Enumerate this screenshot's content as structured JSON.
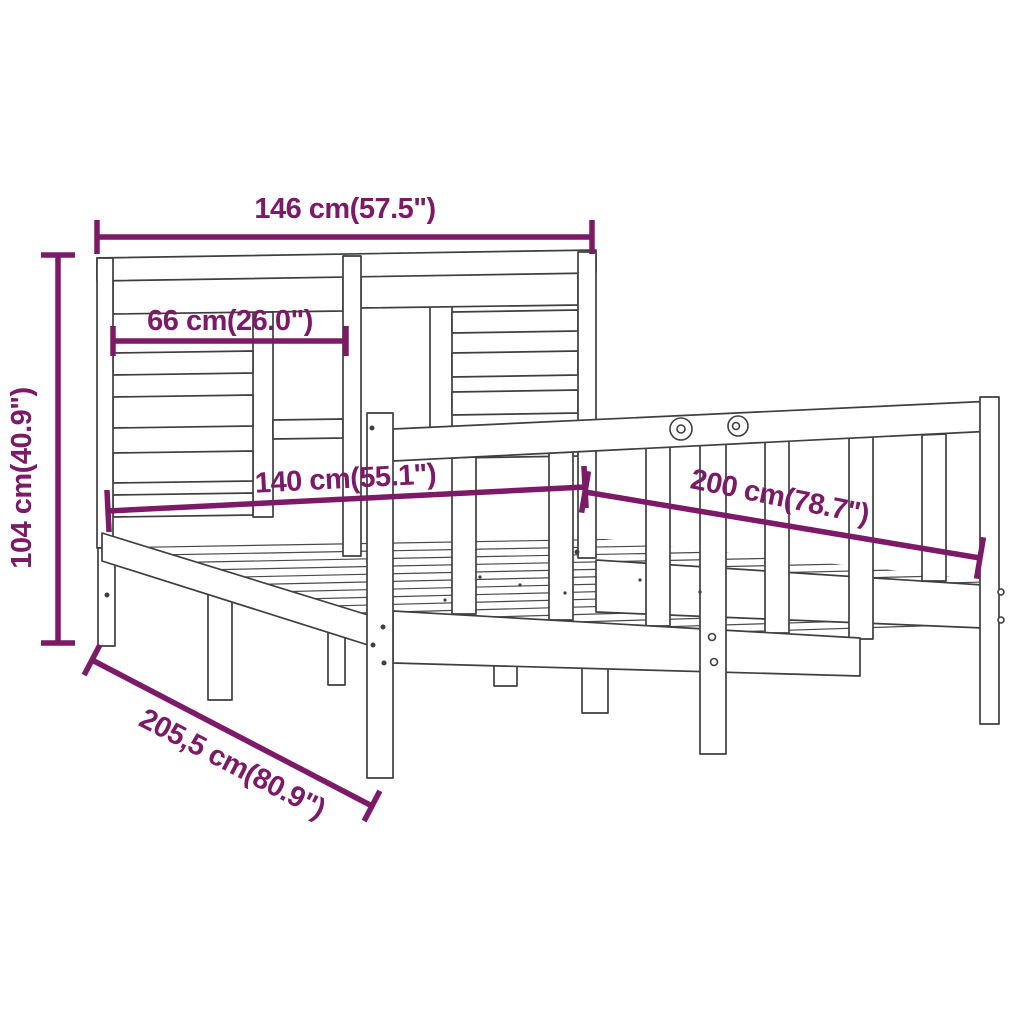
{
  "canvas": {
    "width": 1024,
    "height": 1024,
    "background": "#ffffff"
  },
  "colors": {
    "dimension": "#7c1a67",
    "outline": "#3f3f3f"
  },
  "dimensions": [
    {
      "name": "headboard-total-width",
      "label": "146 cm(57.5\")",
      "x1": 97,
      "y1": 237,
      "x2": 592,
      "y2": 237,
      "tick": 17,
      "tx": 345,
      "ty": 218,
      "rot": 0
    },
    {
      "name": "headboard-inner-width",
      "label": "66 cm(26.0\")",
      "x1": 113,
      "y1": 341,
      "x2": 346,
      "y2": 341,
      "tick": 15,
      "tx": 230,
      "ty": 330,
      "rot": 0
    },
    {
      "name": "headboard-height",
      "label": "104 cm(40.9\")",
      "x1": 58,
      "y1": 255,
      "x2": 58,
      "y2": 643,
      "tick": 17,
      "tx": 31,
      "ty": 478,
      "rot": -90
    },
    {
      "name": "bed-width",
      "label": "140 cm(55.1\")",
      "x1": 108,
      "y1": 511,
      "x2": 585,
      "y2": 487,
      "tick": 21,
      "tx": 346,
      "ty": 488,
      "rot": -3
    },
    {
      "name": "bed-length",
      "label": "200 cm(78.7\")",
      "x1": 585,
      "y1": 492,
      "x2": 980,
      "y2": 558,
      "tick": 21,
      "tx": 778,
      "ty": 506,
      "rot": 11.5
    },
    {
      "name": "frame-total-length",
      "label": "205,5 cm(80.9\")",
      "x1": 92,
      "y1": 660,
      "x2": 372,
      "y2": 806,
      "tick": 17,
      "tx": 228,
      "ty": 772,
      "rot": 27.5
    }
  ],
  "drawing": {
    "platform_clip": "108,540 596,538 983,580 983,626 860,640 393,612 368,645 102,560",
    "platform_lines": [
      {
        "name": "base-slat",
        "x1": 100,
        "y1": 548,
        "x2": 985,
        "y2": 533
      },
      {
        "name": "base-slat",
        "x1": 100,
        "y1": 556,
        "x2": 985,
        "y2": 540
      },
      {
        "name": "base-slat",
        "x1": 100,
        "y1": 564,
        "x2": 985,
        "y2": 547
      },
      {
        "name": "base-slat",
        "x1": 100,
        "y1": 572,
        "x2": 985,
        "y2": 554
      },
      {
        "name": "base-slat",
        "x1": 100,
        "y1": 580,
        "x2": 985,
        "y2": 561
      },
      {
        "name": "base-slat",
        "x1": 100,
        "y1": 588,
        "x2": 985,
        "y2": 568
      },
      {
        "name": "base-slat",
        "x1": 100,
        "y1": 596,
        "x2": 985,
        "y2": 575
      },
      {
        "name": "base-slat",
        "x1": 100,
        "y1": 604,
        "x2": 985,
        "y2": 582
      },
      {
        "name": "base-slat",
        "x1": 100,
        "y1": 612,
        "x2": 985,
        "y2": 589
      },
      {
        "name": "base-slat",
        "x1": 100,
        "y1": 620,
        "x2": 985,
        "y2": 596
      },
      {
        "name": "base-slat",
        "x1": 100,
        "y1": 628,
        "x2": 985,
        "y2": 603
      },
      {
        "name": "base-slat",
        "x1": 100,
        "y1": 636,
        "x2": 985,
        "y2": 610
      },
      {
        "name": "base-slat",
        "x1": 100,
        "y1": 644,
        "x2": 985,
        "y2": 617
      },
      {
        "name": "base-slat",
        "x1": 100,
        "y1": 652,
        "x2": 985,
        "y2": 624
      }
    ],
    "shapes": [
      {
        "name": "headboard-strut-left",
        "points": "253,312 273,312 273,517 253,517"
      },
      {
        "name": "headboard-strut-right",
        "points": "430,306 452,306 452,458 430,458"
      },
      {
        "name": "headboard-slat",
        "points": "113,278 343,275 343,311 113,314"
      },
      {
        "name": "headboard-slat",
        "points": "113,353 253,351 253,373 113,375"
      },
      {
        "name": "headboard-slat",
        "points": "113,397 253,395 253,426 113,428"
      },
      {
        "name": "headboard-slat",
        "points": "113,453 253,451 253,481 113,483"
      },
      {
        "name": "headboard-slat",
        "points": "113,495 253,493 253,515 113,517"
      },
      {
        "name": "headboard-slat",
        "points": "273,420 343,419 343,438 273,439"
      },
      {
        "name": "headboard-slat",
        "points": "361,272 578,269 578,305 361,308"
      },
      {
        "name": "headboard-slat",
        "points": "452,312 578,310 578,331 452,333"
      },
      {
        "name": "headboard-slat",
        "points": "452,353 578,351 578,375 452,377"
      },
      {
        "name": "headboard-slat",
        "points": "452,392 578,390 578,413 452,415"
      },
      {
        "name": "headboard-slat",
        "points": "452,435 578,433 578,456 452,458"
      },
      {
        "name": "headboard-top-rail",
        "points": "97,258 596,250 596,273 97,281"
      },
      {
        "name": "headboard-post-left",
        "points": "97,258 113,258 113,548 97,548"
      },
      {
        "name": "headboard-post-center",
        "points": "343,256 361,256 361,556 343,556"
      },
      {
        "name": "headboard-post-right",
        "points": "578,252 596,252 596,558 578,558"
      },
      {
        "name": "front-left-leg",
        "points": "98,548 115,548 115,646 98,646"
      },
      {
        "name": "left-rail-leg",
        "points": "328,612 345,615 345,685 328,685"
      },
      {
        "name": "mid-left-leg",
        "points": "208,580 232,583 232,700 208,700"
      },
      {
        "name": "left-side-rail",
        "points": "102,533 368,615 368,645 102,561"
      },
      {
        "name": "right-side-rail",
        "points": "596,560 983,585 983,628 596,612"
      },
      {
        "name": "support-leg",
        "points": "494,648 517,650 517,686 494,686"
      },
      {
        "name": "support-leg",
        "points": "582,655 608,658 608,713 582,713"
      },
      {
        "name": "footboard-baluster",
        "points": "452,458 476,457 476,614 452,614"
      },
      {
        "name": "footboard-baluster",
        "points": "549,453 573,452 573,620 549,620"
      },
      {
        "name": "footboard-baluster",
        "points": "646,448 670,447 670,626 646,626"
      },
      {
        "name": "footboard-baluster",
        "points": "765,442 789,441 789,633 765,633"
      },
      {
        "name": "footboard-baluster",
        "points": "849,438 873,437 873,639 849,639"
      },
      {
        "name": "footboard-baluster",
        "points": "922,435 946,434 946,581 922,581"
      },
      {
        "name": "foot-bottom-rail",
        "points": "393,611 860,638 860,676 393,663"
      },
      {
        "name": "footboard-mid-post",
        "points": "700,429 726,428 726,754 700,754"
      },
      {
        "name": "footboard-top-rail",
        "points": "393,429 994,401 994,431 393,461"
      },
      {
        "name": "footboard-post-near",
        "points": "367,413 393,413 393,778 367,778"
      },
      {
        "name": "footboard-post-far",
        "points": "980,397 999,397 999,724 980,724"
      }
    ],
    "circles": [
      {
        "name": "cam-lock-screw",
        "cx": 681,
        "cy": 429,
        "r": 11,
        "solid": false
      },
      {
        "name": "cam-lock-screw",
        "cx": 681,
        "cy": 429,
        "r": 4,
        "solid": false
      },
      {
        "name": "cam-lock-screw",
        "cx": 738,
        "cy": 426,
        "r": 10,
        "solid": false
      },
      {
        "name": "cam-lock-screw",
        "cx": 736,
        "cy": 426,
        "r": 3.5,
        "solid": false
      },
      {
        "name": "screw",
        "cx": 383,
        "cy": 627,
        "r": 2.5,
        "solid": true
      },
      {
        "name": "screw",
        "cx": 373,
        "cy": 645,
        "r": 2.5,
        "solid": true
      },
      {
        "name": "screw",
        "cx": 384,
        "cy": 663,
        "r": 2.5,
        "solid": true
      },
      {
        "name": "screw",
        "cx": 372,
        "cy": 428,
        "r": 2.5,
        "solid": true
      },
      {
        "name": "screw",
        "cx": 712,
        "cy": 637,
        "r": 3.5,
        "solid": false
      },
      {
        "name": "screw",
        "cx": 714,
        "cy": 662,
        "r": 3.5,
        "solid": false
      },
      {
        "name": "screw",
        "cx": 1001,
        "cy": 592,
        "r": 3,
        "solid": false
      },
      {
        "name": "screw",
        "cx": 1001,
        "cy": 620,
        "r": 3,
        "solid": false
      },
      {
        "name": "screw",
        "cx": 107,
        "cy": 595,
        "r": 2.5,
        "solid": true
      },
      {
        "name": "screw",
        "cx": 577,
        "cy": 552,
        "r": 2.5,
        "solid": true
      },
      {
        "name": "fitting-detail",
        "cx": 445,
        "cy": 600,
        "r": 1.6,
        "solid": true
      },
      {
        "name": "fitting-detail",
        "cx": 480,
        "cy": 577,
        "r": 1.6,
        "solid": true
      },
      {
        "name": "fitting-detail",
        "cx": 520,
        "cy": 585,
        "r": 1.6,
        "solid": true
      },
      {
        "name": "fitting-detail",
        "cx": 565,
        "cy": 593,
        "r": 1.6,
        "solid": true
      },
      {
        "name": "fitting-detail",
        "cx": 640,
        "cy": 580,
        "r": 1.6,
        "solid": true
      },
      {
        "name": "fitting-detail",
        "cx": 700,
        "cy": 592,
        "r": 1.6,
        "solid": true
      }
    ]
  }
}
